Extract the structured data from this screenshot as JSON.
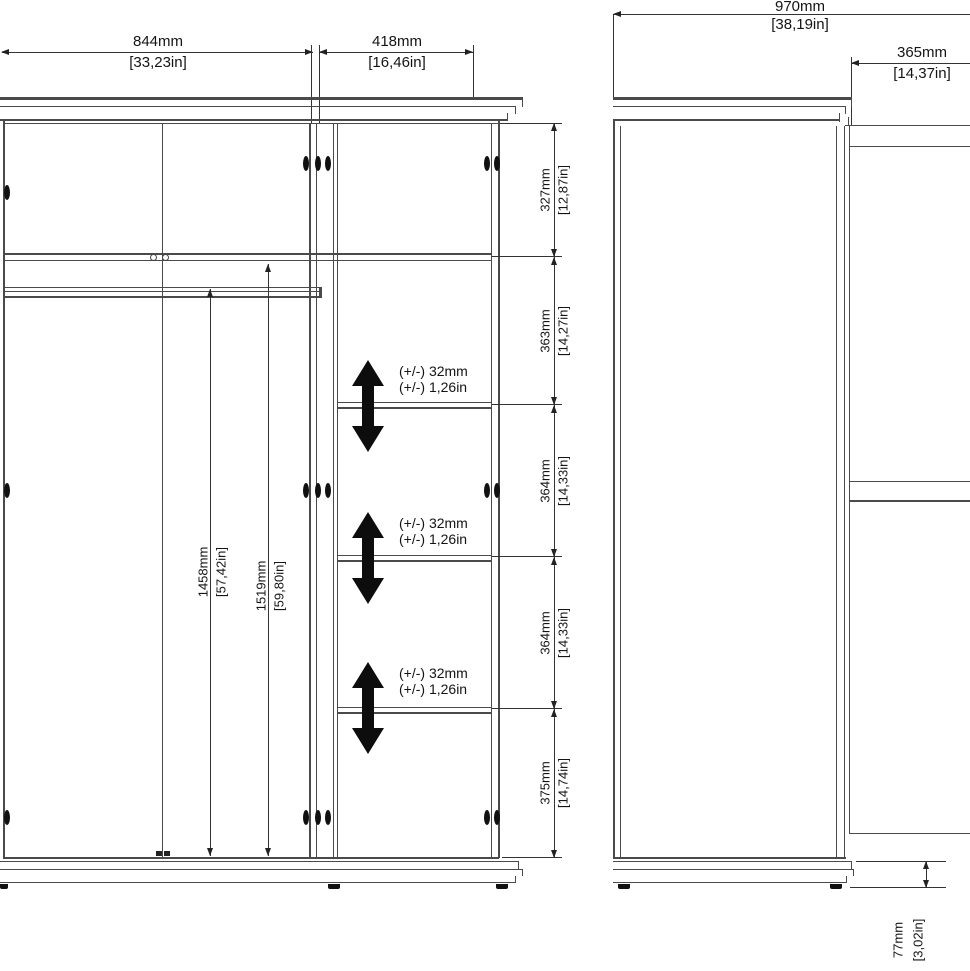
{
  "front_view": {
    "width_dims": {
      "d844": {
        "mm": "844mm",
        "in": "[33,23in]"
      },
      "d418": {
        "mm": "418mm",
        "in": "[16,46in]"
      }
    },
    "interior_heights": {
      "d1458": {
        "mm": "1458mm",
        "in": "[57,42in]"
      },
      "d1519": {
        "mm": "1519mm",
        "in": "[59,80in]"
      }
    },
    "height_chain": [
      {
        "mm": "327mm",
        "in": "[12,87in]"
      },
      {
        "mm": "363mm",
        "in": "[14,27in]"
      },
      {
        "mm": "364mm",
        "in": "[14,33in]"
      },
      {
        "mm": "364mm",
        "in": "[14,33in]"
      },
      {
        "mm": "375mm",
        "in": "[14,74in]"
      }
    ],
    "shelf_adjustability": [
      {
        "mm": "(+/-) 32mm",
        "in": "(+/-) 1,26in"
      },
      {
        "mm": "(+/-) 32mm",
        "in": "(+/-) 1,26in"
      },
      {
        "mm": "(+/-) 32mm",
        "in": "(+/-) 1,26in"
      }
    ]
  },
  "side_view": {
    "overall_width": {
      "mm": "970mm",
      "in": "[38,19in]"
    },
    "top_depth": {
      "mm": "365mm",
      "in": "[14,37in]"
    },
    "plinth_height": {
      "mm": "77mm",
      "in": "[3,02in]"
    }
  }
}
